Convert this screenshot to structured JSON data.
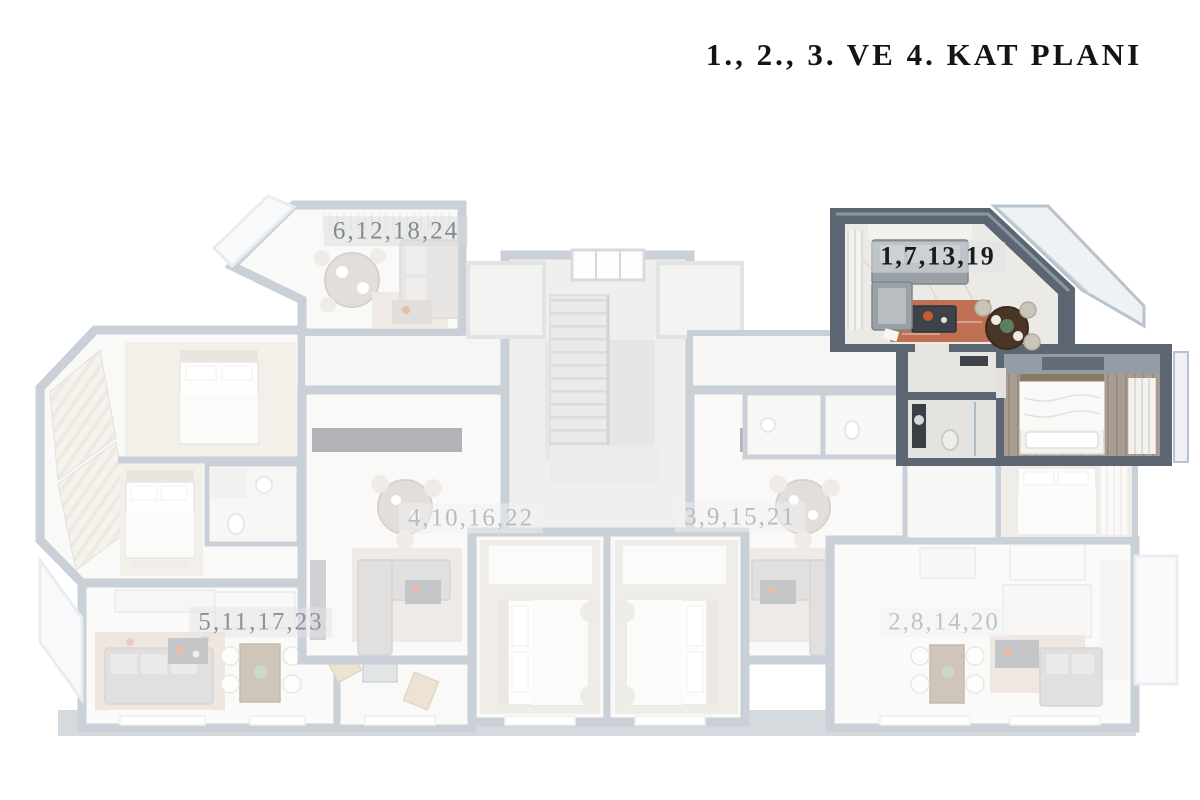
{
  "title": {
    "text": "1., 2., 3. VE 4. KAT PLANI"
  },
  "plan": {
    "units": [
      {
        "label": "6,12,18,24",
        "highlighted": false
      },
      {
        "label": "1,7,13,19",
        "highlighted": true
      },
      {
        "label": "4,10,16,22",
        "highlighted": false
      },
      {
        "label": "3,9,15,21",
        "highlighted": false
      },
      {
        "label": "5,11,17,23",
        "highlighted": false
      },
      {
        "label": "2,8,14,20",
        "highlighted": false
      }
    ],
    "colors": {
      "background": "#ffffff",
      "title_text": "#141414",
      "highlight_wall": "#5c6672",
      "highlight_wall_top": "#8b96a2",
      "faded_wall": "#7b8b9c",
      "marble_floor": "#eceae7",
      "sofa_gray": "#99a1a6",
      "rug_accent": "#b85c38",
      "dining_wood": "#4a3627",
      "bedroom_wood_floor": "#a89d90",
      "label_highlight_text": "#1a1b1d",
      "label_faded_text": "#b7bcc0",
      "label_mid_text": "#85898d"
    }
  }
}
